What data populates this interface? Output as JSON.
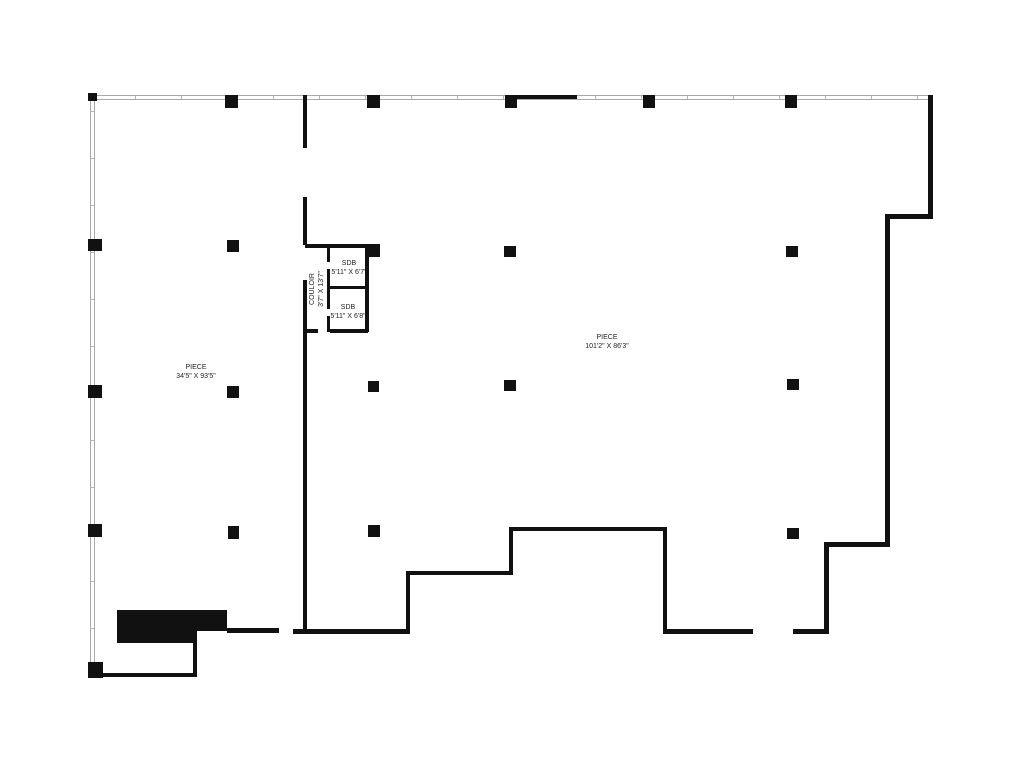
{
  "plan": {
    "colors": {
      "background": "#ffffff",
      "wall_thick": "#111111",
      "wall_thin": "#a9a9a9",
      "column": "#111111",
      "label_text": "#222222"
    },
    "rooms": [
      {
        "id": "piece-left",
        "name": "PIECE",
        "dims": "34'5\" X 93'5\""
      },
      {
        "id": "piece-right",
        "name": "PIECE",
        "dims": "101'2\" X 86'3\""
      },
      {
        "id": "sdb-top",
        "name": "SDB",
        "dims": "5'11\" X 6'7\""
      },
      {
        "id": "sdb-bottom",
        "name": "SDB",
        "dims": "5'11\" X 6'8\""
      },
      {
        "id": "couloir",
        "name": "COULOIR",
        "dims": "3'7\" X 13'7\""
      }
    ]
  }
}
